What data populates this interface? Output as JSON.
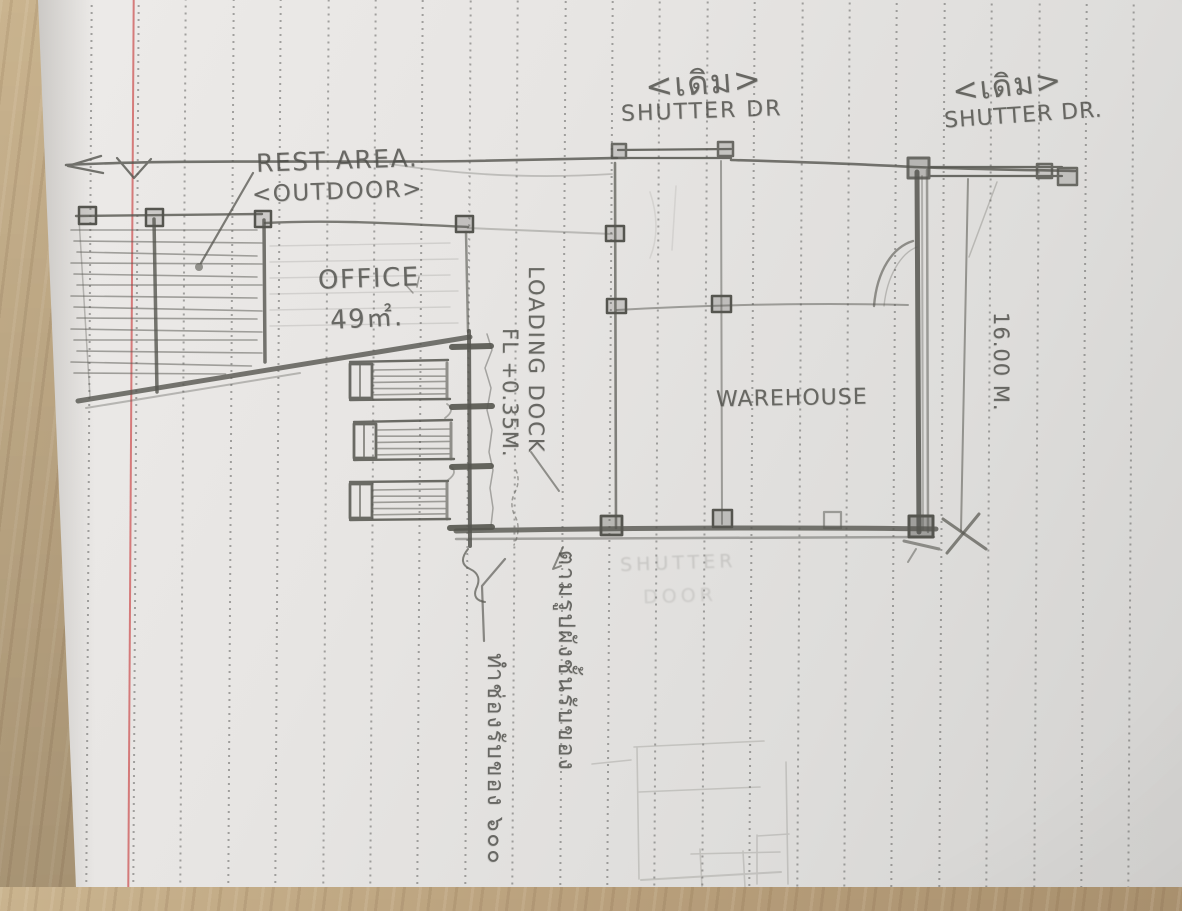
{
  "scene": {
    "description": "Hand-drawn pencil floor-plan sketch on lined notebook paper photographed on a wooden desk",
    "paper_color": "#e6e4e2",
    "desk_wood_color": "#b89f7b",
    "pencil_color": "#55554f",
    "margin_line_color": "#cd5555"
  },
  "annotations": {
    "shutter_mid": {
      "tag": "<เดิม>",
      "label": "SHUTTER DR"
    },
    "shutter_right": {
      "tag": "<เดิม>",
      "label": "SHUTTER DR."
    },
    "rest_area": {
      "line1": "REST AREA.",
      "line2": "<OUTDOOR>"
    },
    "office": {
      "name": "OFFICE",
      "area": "49㎡."
    },
    "loading_dock": {
      "name": "LOADING DOCK",
      "floor_level": "FL +0.35M."
    },
    "warehouse": {
      "name": "WAREHOUSE"
    },
    "dimensions": {
      "right_side_length": "16.00 M."
    },
    "erased_text": {
      "line1": "SHUTTER",
      "line2": "DOOR"
    },
    "thai_notes": {
      "dock_note": "ตามรูปผังชั้นรับของ",
      "opening_note": "ทำช่องรับของ ๖๐๐"
    }
  }
}
